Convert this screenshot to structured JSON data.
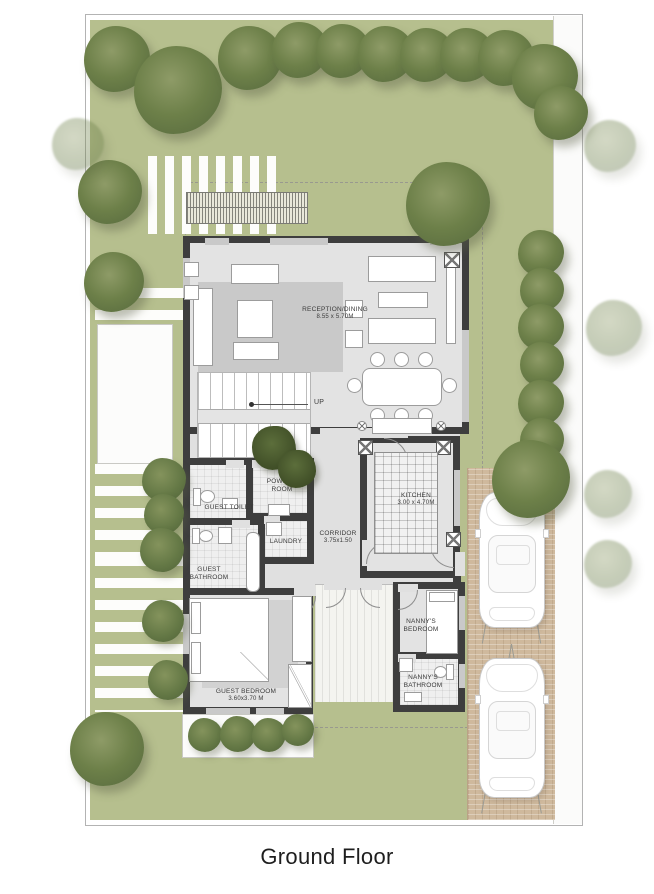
{
  "title": "Ground Floor",
  "rooms": {
    "reception": {
      "name": "RECEPTION/DINING",
      "dims": "8.55 x 5.70M"
    },
    "kitchen": {
      "name": "KITCHEN",
      "dims": "3.00 x 4.70M"
    },
    "corridor": {
      "name": "CORRIDOR",
      "dims": "3.75x1.50"
    },
    "powder_room": {
      "name": "POWDER ROOM"
    },
    "guest_toilet": {
      "name": "GUEST TOILET"
    },
    "laundry": {
      "name": "LAUNDRY"
    },
    "guest_bathroom": {
      "name": "GUEST BATHROOM"
    },
    "guest_bedroom": {
      "name": "GUEST BEDROOM",
      "dims": "3.60x3.70 M"
    },
    "nanny_bedroom": {
      "name": "NANNY'S BEDROOM"
    },
    "nanny_bathroom": {
      "name": "NANNY'S BATHROOM"
    }
  },
  "stairs": {
    "direction_label": "UP"
  },
  "colors": {
    "lawn": "#b6bf8e",
    "tree": "#6d8049",
    "wall": "#3e3e3e",
    "floor": "#e3e3e3",
    "driveway": "#cfb99d"
  }
}
